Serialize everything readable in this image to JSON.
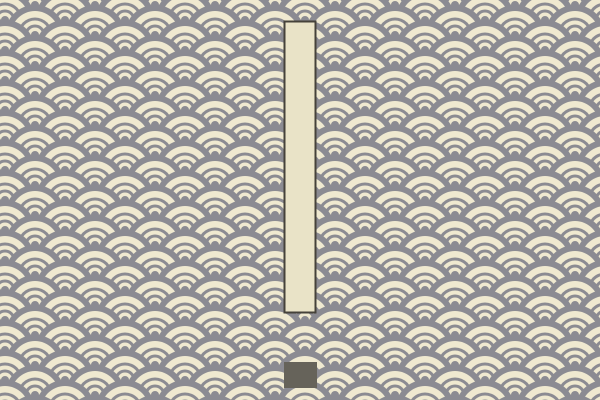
{
  "scene": {
    "name": "seigaiha-wave-game-scene",
    "width": 600,
    "height": 400
  },
  "colors": {
    "cream": "#efe9d0",
    "gray": "#8b8b92"
  },
  "pattern": {
    "tile_width": 60,
    "tile_height": 30,
    "phase_x": 35,
    "phase_y": 5,
    "circle_centers": [
      [
        30,
        -15
      ],
      [
        0,
        0
      ],
      [
        60,
        0
      ],
      [
        -30,
        15
      ],
      [
        30,
        15
      ],
      [
        90,
        15
      ],
      [
        0,
        30
      ],
      [
        60,
        30
      ],
      [
        -30,
        45
      ],
      [
        30,
        45
      ],
      [
        90,
        45
      ]
    ],
    "rings": [
      {
        "r": 30,
        "color": "gray"
      },
      {
        "r": 24,
        "color": "cream"
      },
      {
        "r": 17.5,
        "color": "gray"
      },
      {
        "r": 14.5,
        "color": "cream"
      },
      {
        "r": 10.5,
        "color": "gray"
      },
      {
        "r": 7.5,
        "color": "cream"
      },
      {
        "r": 4,
        "color": "gray"
      }
    ]
  },
  "paddle": {
    "x": 284.5,
    "y": 21.5,
    "width": 31,
    "height": 291,
    "fill": "#e9e3c7",
    "stroke": "#45423a",
    "stroke_width": 2
  },
  "block": {
    "x": 284,
    "y": 362,
    "width": 33,
    "height": 26,
    "fill": "#66635a"
  }
}
